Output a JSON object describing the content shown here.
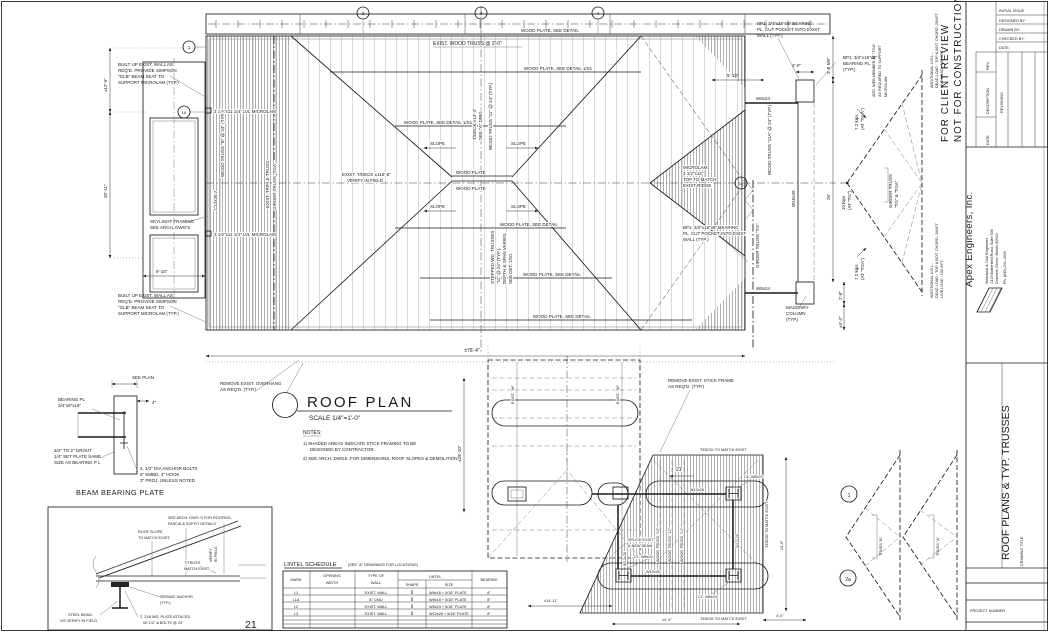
{
  "stamp": {
    "l1": "FOR CLIENT REVIEW",
    "l2": "NOT FOR CONSTRUCTION"
  },
  "tb": {
    "initial": "INITIAL ISSUE",
    "designed": "DESIGNED BY:",
    "drawn": "DRAWN BY:",
    "checked": "CHECKED BY:",
    "date_lbl": "DATE:",
    "rev": "REV.",
    "descr": "DESCRIPTION",
    "date": "DATE",
    "revisions": "REVISIONS",
    "firm_name": "Apex Engineers, Inc.",
    "firm_tag": "Structural & Civil Engineers",
    "addr1": "1319 Butterfield Road, Suite 500",
    "addr2": "Downers Grove, Illinois 60515",
    "phone": "Ph. (630) 241-1600",
    "dtitle_lbl": "DRAWING TITLE",
    "dtitle": "ROOF PLANS & TYP. TRUSSES",
    "proj": "PROJECT NUMBER"
  },
  "plan": {
    "exist_truss": "EXIST. WOOD TRUSS @ 2'-0\"",
    "wp_detail": "WOOD PLATE, SEE DETAIL",
    "wp_detail_1s1": "WOOD PLATE, SEE DETAIL 1/S1",
    "wood_plate": "WOOD PLATE",
    "slope": "SLOPE",
    "tdeck_exist_1": "EXIST. T/DECK ±118'-8\"",
    "tdeck_exist_2": "VERIFY IN FIELD",
    "tdeck13_1": "T/DECK ±13'-4\"",
    "tdeck13_2": "SEE \"A\" DWG.",
    "truss11": "WOOD TRUSS \"11\" @ 24\" (TYP.)",
    "truss11a": "WOOD TRUSS \"11A\" @ 24\" (TYP.)",
    "stepped_1": "STEPPED WD. TRUSSES",
    "stepped_2": "\"11\" @ 24\" (TYP.),",
    "stepped_3": "DEPTH & SPAN VARIES,",
    "stepped_4": "SEE DET. 1/S1",
    "built_1": "BUILT UP EXIST. WALL AS",
    "built_2": "REQ'D. PROVIDE SIMPSON",
    "built_3": "\"GLB\" BEAM SEAT TO",
    "built_4": "SUPPORT MICROLAM (TYP.)",
    "lvl": "3 1/2\"x11 1/4\" LVL MICROLAM",
    "c12": "C12x20.7",
    "sky_1": "SKYLIGHT FRAMING",
    "sky_2": "SEE ARCH. DWG'S.",
    "truss_b_note": "WOOD TRUSS \"B\" @ 24\" (TYP.)",
    "triple": "EXIST. TRIPLE TRUSS",
    "girder_tga": "GIRDER TRUSS \"TGA\"",
    "girder_tg": "GIRDER TRUSS \"TG\"",
    "bp1_1": "BP1: 3/4\"x16\"x8\" BEARING",
    "bp1_2": "PL. CUT POCKET INTO EXIST.",
    "bp1_3": "WALL (TYP.)",
    "bp1s_1": "BP1: 3/4\"x16\"x8\"",
    "bp1s_2": "BEARING PL.",
    "bp1s_3": "(TYP.)",
    "w8x24": "W8x24",
    "w10x39": "W10x39",
    "micro_1": "MICROLAM",
    "micro_2": "3 1/2\"x14\"",
    "micro_3": "TOP TO MATCH",
    "micro_4": "EXIST RIDGE",
    "mas_1": "MASONRY",
    "mas_2": "COLUMN",
    "mas_3": "(TYP.)",
    "rem_oh_1": "REMOVE EXIST. OVERHANG",
    "rem_oh_2": "AS REQ'D.  (TYP.)",
    "rem_st_1": "REMOVE EXIST. STICK FRAME",
    "rem_st_2": "AS REQ'D.  (TYP.)"
  },
  "dims": {
    "d12_5": "±12'-5\"",
    "d20_11": "20'-11\"",
    "d6_10": "6'-10\"",
    "d5_10": "5'-10\"",
    "d2_0": "2'-0\"",
    "d2_85": "2'-8 5/8\"",
    "d26": "26'",
    "d2_8": "2'-8\"",
    "d4_4": "±4'-4\"",
    "d76_4": "±76'-4\"",
    "d29_10": "±29'-10\"",
    "d23_6": "23'-6\"",
    "d14_0": "14'-0\"",
    "d4_0": "4'-0\"",
    "d14_11": "±14'-11\""
  },
  "grid": {
    "g1": "1",
    "g1a": "1A",
    "g2": "2",
    "g3": "3",
    "g4": "4",
    "g13": "13"
  },
  "diag": {
    "k72_1": "7.2 kips",
    "k72_2": "(AT \"TGA\")",
    "k10_1": "10 kips",
    "k10_2": "(AT \"TG\")",
    "gb_1": "GIRDER TRUSS",
    "gb_2": "\"TG\" & \"TGA\"",
    "aw_1": "ADD. WEB MEMBER AT \"TGA\"",
    "aw_2": "AS REQUIRED TO SUPPORT",
    "aw_3": "MICROLAM",
    "udl_1": "ADDITIONAL U.D.L.:",
    "udl_2": "DEAD LOAD : TOP & BOT. CHORD: 20#/FT",
    "udl_3": "LIVE LOAD : 150 #/FT."
  },
  "rp": {
    "title": "ROOF PLAN",
    "scale": "SCALE 1/4\"=1'-0\"",
    "north": "NORTH",
    "notes_title": "NOTES:",
    "note1a": "1) SHADED AREAS INDICATE STICK FRAMING TO BE",
    "note1b": "DESIGNED BY CONTRACTOR.",
    "note2": "2) SEE ARCH. DWGS. FOR DIMENSIONS, ROOF SLOPES & DEMOLITION"
  },
  "lp": {
    "tdeck": "T/DECK TO MATCH EXIST.",
    "c1": "C1: W8x24",
    "w12x26": "W12x26",
    "splice_1": "SPLICE EXIST.",
    "splice_2": "& NEW BEAM",
    "wt10": "WOOD TRUSS \"10\"",
    "wt12": "WOOD TRUSS \"12\"",
    "wt14": "WOOD TRUSS \"14\"",
    "exist_w": "EXIST. \"W\"",
    "ref21": "21"
  },
  "tr": {
    "truss_a": "TRUSS \"A\"",
    "truss_b": "TRUSS \"B\"",
    "m1": "1",
    "m2a": "2a"
  },
  "bd": {
    "see_plan": "SEE PLAN",
    "pl_1": "BEARING PL",
    "pl_2": "3/4\"x8\"x16\"",
    "four": "4\"",
    "grout_1": "3/4\" TO 2\" GROUT",
    "grout_2": "1/4\" SET PLATE SAME",
    "grout_3": "SIZE AS BEARING P L",
    "anch_1": "2, 1/2\" DIA ANCHOR BOLTS",
    "anch_2": "8\" EMBD, 4\" HOOK",
    "anch_3": "3\" PROJ. UNLESS NOTED",
    "title": "BEAM BEARING PLATE"
  },
  "td": {
    "arch_1": "SEE ARCH. DWG.'S FOR ROOFING,",
    "arch_2": "FASCIA & SOFFIT DETAILS.",
    "slope_1": "ROOF SLOPE",
    "slope_2": "TO MATCH EXIST.",
    "verify_1": "VERIFY",
    "verify_2": "IN FIELD",
    "ttruss_1": "T/TRUSS",
    "ttruss_2": "MATCH EXIST.",
    "seis_1": "SEISMIC ANCHOR",
    "seis_2": "(TYP.)",
    "steel_1": "STEEL BEAM",
    "steel_2": "1/S VERIFY IN FIELD",
    "plate_1": "2, 2X8 WD. PLATE ATTACED",
    "plate_2": "W/ 1/2\" ø BOLTS @ 24\"",
    "page": "21"
  },
  "ls": {
    "title": "LINTEL SCHEDULE",
    "subtitle": "(SEE \"A\" DRAWINGS FOR LOCATIONS)",
    "h_mark": "MARK",
    "h_open_1": "OPENING",
    "h_open_2": "WIDTH",
    "h_type_1": "TYPE OF",
    "h_type_2": "WALL",
    "h_lintel": "LINTEL",
    "h_shape": "SHAPE",
    "h_size": "SIZE",
    "h_bearing": "BEARING",
    "rows": [
      {
        "mark": "L1",
        "opening": "",
        "type": "EXIST. WALL",
        "shape": "I",
        "size": "W8x18 + 5/16\" PLATE",
        "bearing": "8\""
      },
      {
        "mark": "L1A",
        "opening": "",
        "type": "8\" CMU",
        "shape": "I",
        "size": "W8x18 + 5/16\" PLATE",
        "bearing": "8\""
      },
      {
        "mark": "L2",
        "opening": "",
        "type": "EXIST. WALL",
        "shape": "I",
        "size": "W8x24 + 5/16\" PLATE",
        "bearing": "8\""
      },
      {
        "mark": "L3",
        "opening": "",
        "type": "EXIST. WALL",
        "shape": "I",
        "size": "W12x26 + 5/16\" PLATE",
        "bearing": "8\""
      }
    ]
  }
}
